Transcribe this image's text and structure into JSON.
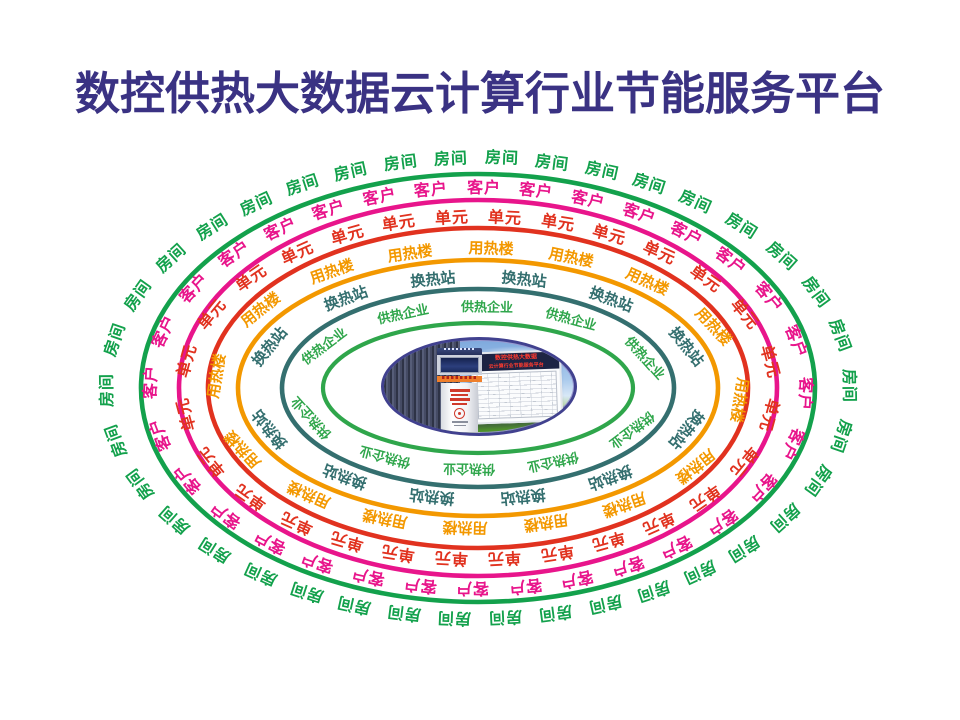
{
  "title": {
    "text": "数控供热大数据云计算行业节能服务平台",
    "color": "#3A3283"
  },
  "diagram": {
    "center": {
      "x": 478,
      "y": 388
    },
    "rings": [
      {
        "name": "room",
        "label": "房间",
        "color": "#13A14C",
        "count": 38,
        "line_a": 337,
        "line_b": 214,
        "text_a": 370,
        "text_b": 229,
        "stroke_width": 4.6,
        "font_size": 16,
        "phase": 0.45
      },
      {
        "name": "customer",
        "label": "客户",
        "color": "#E8158B",
        "count": 32,
        "line_a": 299,
        "line_b": 188,
        "text_a": 326,
        "text_b": 199,
        "stroke_width": 4.6,
        "font_size": 16,
        "phase": 0.1
      },
      {
        "name": "unit",
        "label": "单元",
        "color": "#E1321F",
        "count": 28,
        "line_a": 270,
        "line_b": 160,
        "text_a": 294,
        "text_b": 170,
        "stroke_width": 4.6,
        "font_size": 16,
        "phase": 0.5
      },
      {
        "name": "heat-building",
        "label": "用热楼",
        "color": "#F39800",
        "count": 16,
        "line_a": 240,
        "line_b": 128,
        "text_a": 262,
        "text_b": 139,
        "stroke_width": 4.6,
        "font_size": 15,
        "phase": 0.15
      },
      {
        "name": "heat-exchange-station",
        "label": "换热站",
        "color": "#346F6F",
        "count": 12,
        "line_a": 196,
        "line_b": 99,
        "text_a": 224,
        "text_b": 110,
        "stroke_width": 4.6,
        "font_size": 15,
        "phase": 0.5
      },
      {
        "name": "heat-supply-enterprise",
        "label": "供热企业",
        "color": "#2FA64B",
        "count": 10,
        "line_a": 155,
        "line_b": 65,
        "text_a": 180,
        "text_b": 81,
        "stroke_width": 4.2,
        "font_size": 13,
        "phase": 0.1
      }
    ]
  },
  "center_photo": {
    "border_color": "#41418F",
    "board_title_line1": "数控供热大数据",
    "board_title_line2": "云计算行业节能服务平台"
  }
}
